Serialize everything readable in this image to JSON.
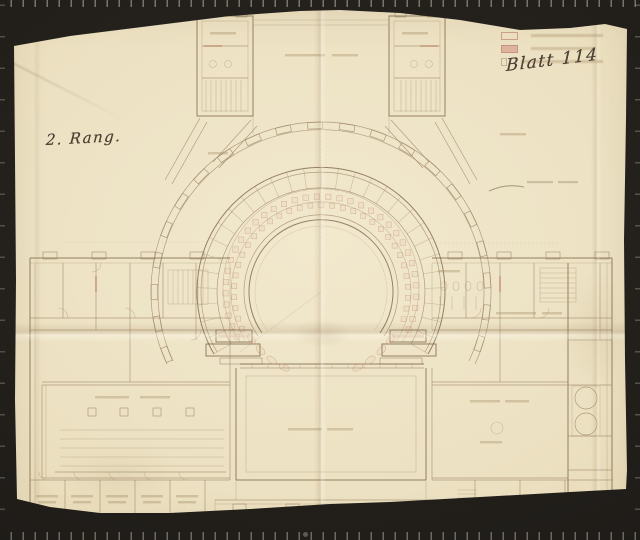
{
  "handwriting": {
    "rank_note": "2. Rang.",
    "sheet_note": "Blatt 114"
  },
  "legend": {
    "items": [
      {
        "swatch": "outlined-box",
        "swatch_color": "#c08578",
        "label": ""
      },
      {
        "swatch": "filled-box",
        "swatch_color": "#cd8773",
        "label": ""
      },
      {
        "swatch": "small-tick",
        "swatch_color": "#a8906c",
        "label": ""
      }
    ]
  },
  "colors": {
    "background": "#221f1b",
    "paper": "#ece1c2",
    "plan_line": "#9c8466",
    "red_accent": "#c08068",
    "ink": "#4c4134"
  }
}
